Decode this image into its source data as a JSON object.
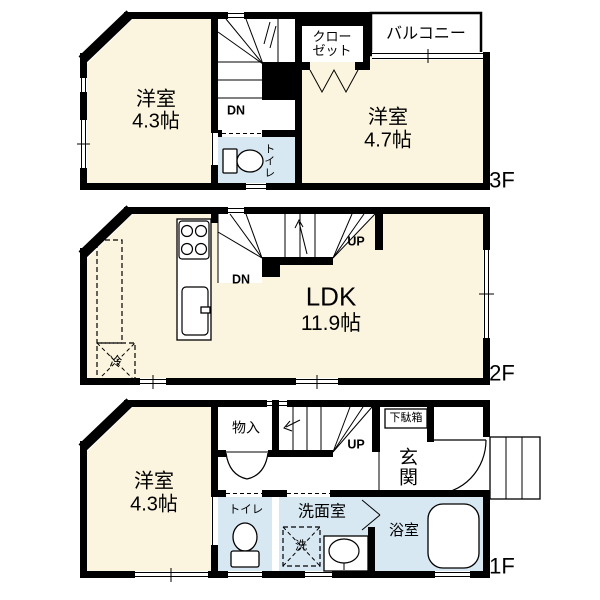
{
  "colors": {
    "wall": "#000000",
    "room": "#FBF5DF",
    "wet": "#D8E8F3",
    "bg": "#FFFFFF",
    "line": "#000000"
  },
  "floor3": {
    "label": "3F",
    "room1_name": "洋室",
    "room1_size": "4.3帖",
    "room2_name": "洋室",
    "room2_size": "4.7帖",
    "closet_line1": "クロー",
    "closet_line2": "ゼット",
    "balcony": "バルコニー",
    "toilet": "トイレ",
    "stairs_dn": "DN"
  },
  "floor2": {
    "label": "2F",
    "ldk_name": "LDK",
    "ldk_size": "11.9帖",
    "stairs_up": "UP",
    "stairs_dn": "DN",
    "fridge": "冷"
  },
  "floor1": {
    "label": "1F",
    "room_name": "洋室",
    "room_size": "4.3帖",
    "storage": "物入",
    "stairs_up": "UP",
    "shoe_cabinet": "下駄箱",
    "entrance": "玄関",
    "toilet": "トイレ",
    "washroom": "洗面室",
    "washer": "洗",
    "bathroom": "浴室"
  }
}
